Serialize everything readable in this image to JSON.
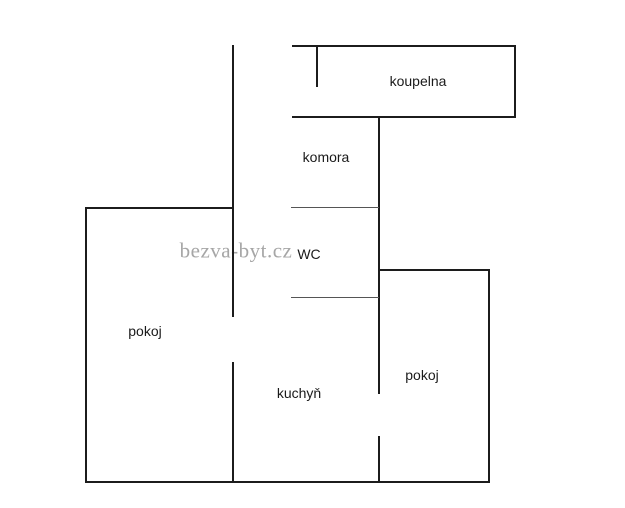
{
  "watermark": {
    "text": "bezva-byt.cz",
    "color": "#a6a6a6",
    "cx": 236,
    "cy": 251
  },
  "floor_plan": {
    "canvas": {
      "width": 625,
      "height": 508
    },
    "wall_color": "#1c1c1c",
    "divider_color": "#555555",
    "rooms": [
      {
        "id": "koupelna",
        "label": "koupelna",
        "cx": 418,
        "cy": 81
      },
      {
        "id": "komora",
        "label": "komora",
        "cx": 326,
        "cy": 157
      },
      {
        "id": "wc",
        "label": "WC",
        "cx": 309,
        "cy": 254
      },
      {
        "id": "pokoj-left",
        "label": "pokoj",
        "cx": 145,
        "cy": 331
      },
      {
        "id": "kuchyn",
        "label": "kuchyň",
        "cx": 299,
        "cy": 393
      },
      {
        "id": "pokoj-right",
        "label": "pokoj",
        "cx": 422,
        "cy": 375
      }
    ],
    "walls": [
      {
        "name": "corridor-wall-upper",
        "x": 232,
        "y": 45,
        "w": 2,
        "h": 272,
        "thin": false
      },
      {
        "name": "corridor-wall-lower",
        "x": 232,
        "y": 362,
        "w": 2,
        "h": 121,
        "thin": false
      },
      {
        "name": "koupelna-top-wall",
        "x": 292,
        "y": 45,
        "w": 224,
        "h": 2,
        "thin": false
      },
      {
        "name": "koupelna-right-wall",
        "x": 514,
        "y": 45,
        "w": 2,
        "h": 73,
        "thin": false
      },
      {
        "name": "koupelna-bottom-wall",
        "x": 292,
        "y": 116,
        "w": 224,
        "h": 2,
        "thin": false
      },
      {
        "name": "koupelna-entry-wall",
        "x": 316,
        "y": 45,
        "w": 2,
        "h": 42,
        "thin": false
      },
      {
        "name": "right-mid-wall-upper",
        "x": 378,
        "y": 116,
        "w": 2,
        "h": 278,
        "thin": false
      },
      {
        "name": "right-mid-wall-lower",
        "x": 378,
        "y": 436,
        "w": 2,
        "h": 47,
        "thin": false
      },
      {
        "name": "komora-wc-divider",
        "x": 291,
        "y": 207,
        "w": 88,
        "h": 1,
        "thin": true
      },
      {
        "name": "wc-bottom-divider",
        "x": 291,
        "y": 297,
        "w": 88,
        "h": 1,
        "thin": true
      },
      {
        "name": "pokoj-left-top-wall",
        "x": 85,
        "y": 207,
        "w": 148,
        "h": 2,
        "thin": false
      },
      {
        "name": "left-outer-wall",
        "x": 85,
        "y": 207,
        "w": 2,
        "h": 276,
        "thin": false
      },
      {
        "name": "bottom-outer-wall",
        "x": 85,
        "y": 481,
        "w": 405,
        "h": 2,
        "thin": false
      },
      {
        "name": "pokoj-right-top-wall",
        "x": 378,
        "y": 269,
        "w": 112,
        "h": 2,
        "thin": false
      },
      {
        "name": "right-outer-wall",
        "x": 488,
        "y": 269,
        "w": 2,
        "h": 214,
        "thin": false
      }
    ]
  }
}
